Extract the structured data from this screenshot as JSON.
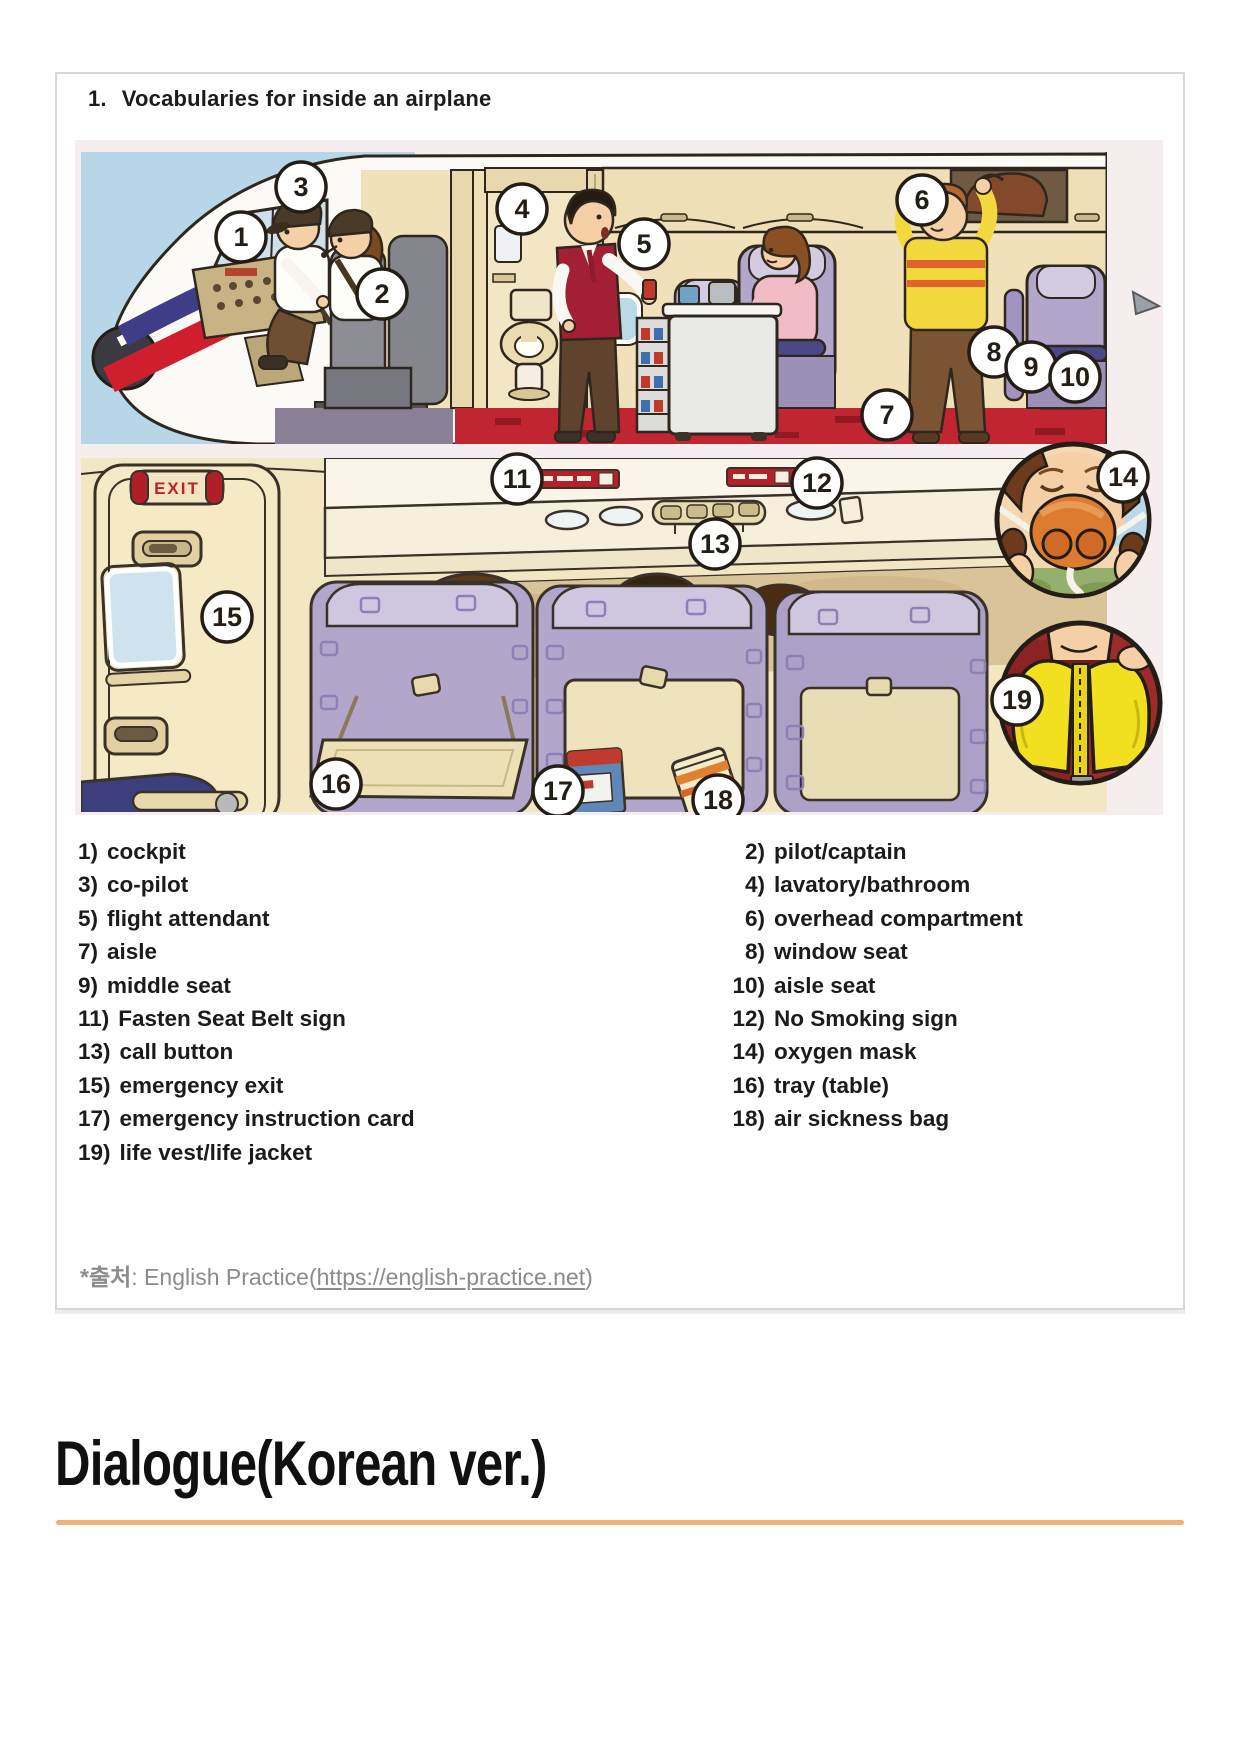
{
  "card": {
    "title_number": "1.",
    "title_text": "Vocabularies for inside an airplane"
  },
  "illustration": {
    "description": "Cartoon cutaway of an airplane interior with numbered parts (cockpit, cabin, seats, safety items)",
    "exit_sign_text": "EXIT",
    "badge_numbers": [
      "1",
      "2",
      "3",
      "4",
      "5",
      "6",
      "7",
      "8",
      "9",
      "10",
      "11",
      "12",
      "13",
      "14",
      "15",
      "16",
      "17",
      "18",
      "19"
    ],
    "colors": {
      "sky": "#b7d7e9",
      "cabin_wall": "#f0e1ba",
      "seat_lavender": "#b2a7cb",
      "carpet_red": "#c02531",
      "stripe_navy": "#3f3c88",
      "stripe_red": "#cf1f2e",
      "life_vest_yellow": "#f2df20",
      "oxygen_mask_orange": "#dd7b31",
      "exit_sign_red": "#b01f28"
    }
  },
  "vocab": {
    "left": [
      {
        "num": "1)",
        "label": "cockpit"
      },
      {
        "num": "3)",
        "label": "co-pilot"
      },
      {
        "num": "5)",
        "label": "flight attendant"
      },
      {
        "num": "7)",
        "label": "aisle"
      },
      {
        "num": "9)",
        "label": "middle seat"
      },
      {
        "num": "11)",
        "label": "Fasten Seat Belt sign"
      },
      {
        "num": "13)",
        "label": "call button"
      },
      {
        "num": "15)",
        "label": "emergency exit"
      },
      {
        "num": "17)",
        "label": "emergency instruction card"
      },
      {
        "num": "19)",
        "label": "life vest/life jacket"
      }
    ],
    "right": [
      {
        "num": "2)",
        "label": "pilot/captain"
      },
      {
        "num": "4)",
        "label": "lavatory/bathroom"
      },
      {
        "num": "6)",
        "label": "overhead compartment"
      },
      {
        "num": "8)",
        "label": "window seat"
      },
      {
        "num": "10)",
        "label": "aisle seat"
      },
      {
        "num": "12)",
        "label": "No Smoking sign"
      },
      {
        "num": "14)",
        "label": "oxygen mask"
      },
      {
        "num": "16)",
        "label": "tray (table)"
      },
      {
        "num": "18)",
        "label": "air sickness bag"
      }
    ]
  },
  "source": {
    "label": "*출처",
    "mid_text": ": English Practice(",
    "link_text": "https://english-practice.net",
    "link_url": "https://english-practice.net",
    "close_text": ")"
  },
  "section": {
    "heading": "Dialogue(Korean ver.)",
    "rule_color": "#f2b179"
  }
}
